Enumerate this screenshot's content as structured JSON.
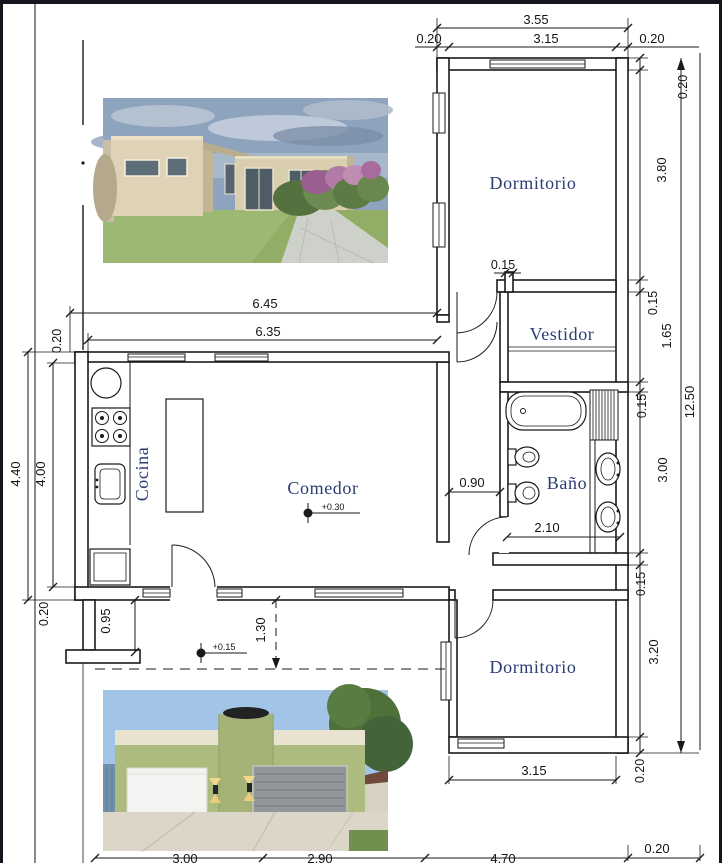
{
  "plan": {
    "rooms": {
      "dormitorio_top": "Dormitorio",
      "vestidor": "Vestidor",
      "bano": "Baño",
      "cocina": "Cocina",
      "comedor": "Comedor",
      "dormitorio_bottom": "Dormitorio"
    },
    "levels": {
      "comedor": "+0.30",
      "galeria": "+0.15"
    },
    "dims": {
      "top_overall": "3.55",
      "top_wall_left": "0.20",
      "top_inner": "3.15",
      "top_wall_right": "0.20",
      "right_wall_top": "0.20",
      "right_dorm_top": "3.80",
      "right_wall_a": "0.15",
      "right_vestidor": "1.65",
      "right_wall_b": "0.15",
      "right_bano": "3.00",
      "right_wall_c": "0.15",
      "right_dorm_bottom": "3.20",
      "right_wall_d": "0.20",
      "right_total": "12.50",
      "kitchen_overall": "6.45",
      "kitchen_inner": "6.35",
      "left_wall_top": "0.20",
      "left_outer": "4.40",
      "left_inner": "4.00",
      "left_wall_bottom": "0.20",
      "porch_left": "0.95",
      "porch_right": "1.30",
      "vestidor_niche": "0.15",
      "hall_width": "0.90",
      "bano_width": "2.10",
      "dorm_bottom_width": "3.15",
      "dorm_bottom_wall": "0.20",
      "bottom_seg1": "3.00",
      "bottom_seg2": "2.90",
      "bottom_seg3": "4.70",
      "bottom_seg4": "0.20"
    },
    "colors": {
      "room_label": "#2a3e74",
      "dimension_text": "#141414",
      "line": "#1a1a1a",
      "facade_olive": "#aebb7e",
      "facade_beige": "#ded3b6",
      "sky": "#a2c4e6"
    }
  }
}
